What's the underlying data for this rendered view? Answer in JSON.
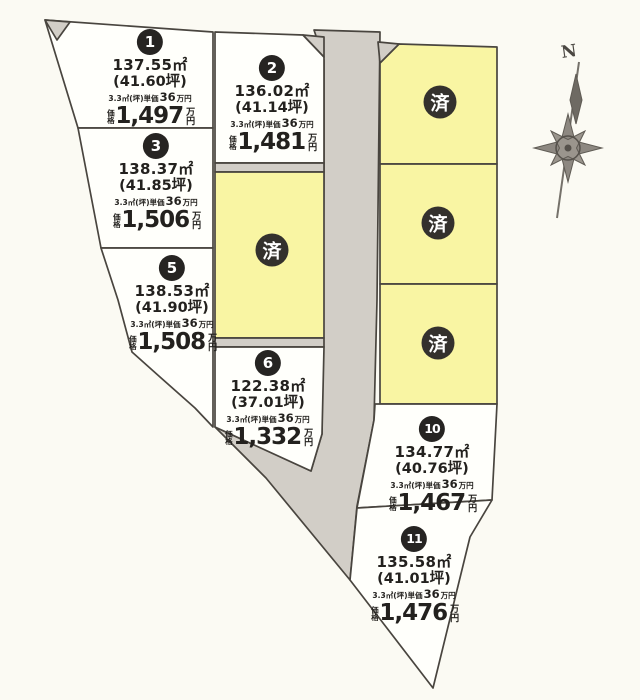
{
  "document": {
    "type": "land-lot-map",
    "compass": {
      "north_label": "N"
    },
    "sold_label": "済",
    "labels": {
      "unit_prefix": "3.3㎡(坪)単価",
      "man_yen": "万円",
      "price_label": "価格",
      "price_unit": "万円"
    },
    "colors": {
      "plot_fill": "#fffffb",
      "sold_fill": "#f9f5a3",
      "road_fill": "#d2cec7",
      "badge_fill": "#262422",
      "line": "#49453f"
    },
    "plots": [
      {
        "number": "1",
        "area": "137.55㎡",
        "tsubo": "(41.60坪)",
        "unit_price": "36",
        "price": "1,497",
        "status": "available"
      },
      {
        "number": "2",
        "area": "136.02㎡",
        "tsubo": "(41.14坪)",
        "unit_price": "36",
        "price": "1,481",
        "status": "available"
      },
      {
        "number": "3",
        "area": "138.37㎡",
        "tsubo": "(41.85坪)",
        "unit_price": "36",
        "price": "1,506",
        "status": "available"
      },
      {
        "number": "5",
        "area": "138.53㎡",
        "tsubo": "(41.90坪)",
        "unit_price": "36",
        "price": "1,508",
        "status": "available"
      },
      {
        "number": "6",
        "area": "122.38㎡",
        "tsubo": "(37.01坪)",
        "unit_price": "36",
        "price": "1,332",
        "status": "available"
      },
      {
        "number": "10",
        "area": "134.77㎡",
        "tsubo": "(40.76坪)",
        "unit_price": "36",
        "price": "1,467",
        "status": "available"
      },
      {
        "number": "11",
        "area": "135.58㎡",
        "tsubo": "(41.01坪)",
        "unit_price": "36",
        "price": "1,476",
        "status": "available"
      }
    ],
    "sold_count": 4
  }
}
